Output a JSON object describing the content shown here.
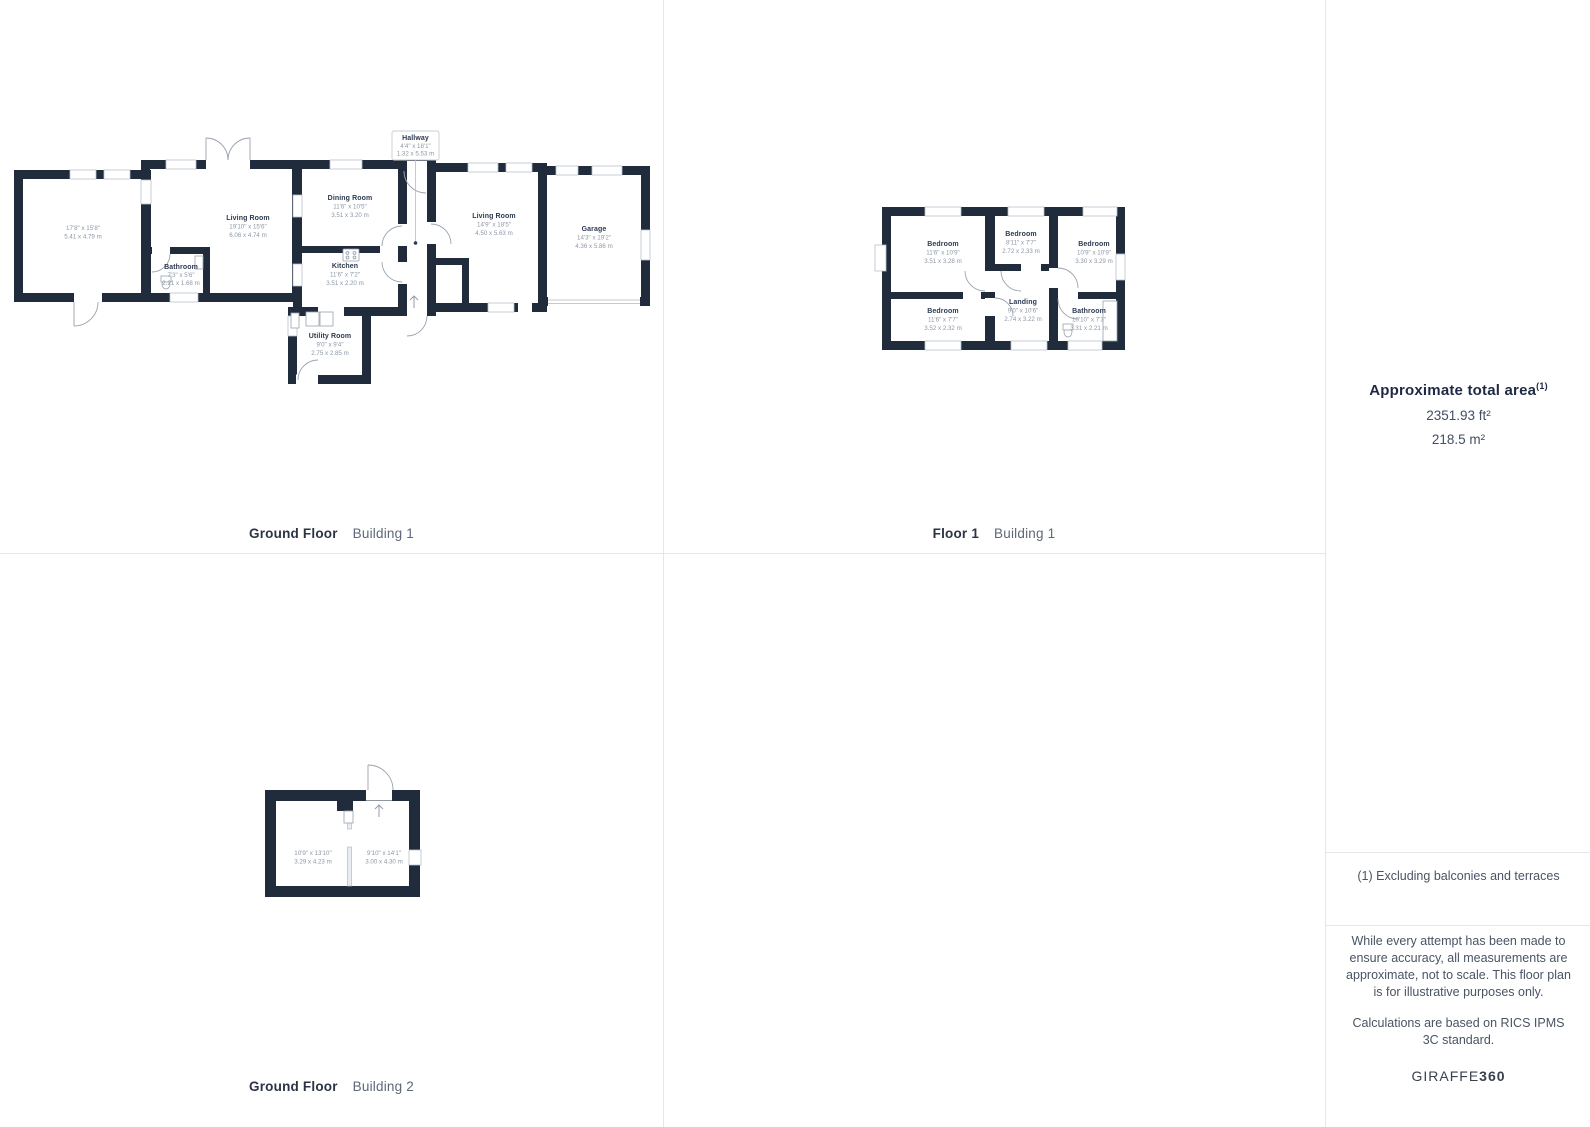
{
  "colors": {
    "wall": "#202c3c",
    "room_name": "#2c3a52",
    "room_dims": "#8e97a6",
    "divider": "#e4e6ea"
  },
  "plans": {
    "gf_b1": {
      "caption": {
        "floor": "Ground Floor",
        "building": "Building 1"
      },
      "rooms": [
        {
          "name": "",
          "imperial": "17'8\" x 15'8\"",
          "metric": "5.41 x 4.79 m"
        },
        {
          "name": "Living Room",
          "imperial": "19'10\" x 15'6\"",
          "metric": "6.06 x 4.74 m"
        },
        {
          "name": "Bathroom",
          "imperial": "7'3\" x 5'6\"",
          "metric": "2.21 x 1.68 m"
        },
        {
          "name": "Dining Room",
          "imperial": "11'6\" x 10'5\"",
          "metric": "3.51 x 3.20 m"
        },
        {
          "name": "Kitchen",
          "imperial": "11'6\" x 7'2\"",
          "metric": "3.51 x 2.20 m"
        },
        {
          "name": "Hallway",
          "imperial": "4'4\" x 18'1\"",
          "metric": "1.32 x 5.53 m"
        },
        {
          "name": "Living Room",
          "imperial": "14'9\" x 18'5\"",
          "metric": "4.50 x 5.63 m"
        },
        {
          "name": "Garage",
          "imperial": "14'3\" x 19'2\"",
          "metric": "4.36 x 5.86 m"
        },
        {
          "name": "Utility Room",
          "imperial": "9'0\" x 9'4\"",
          "metric": "2.75 x 2.85 m"
        }
      ]
    },
    "f1_b1": {
      "caption": {
        "floor": "Floor 1",
        "building": "Building 1"
      },
      "rooms": [
        {
          "name": "Bedroom",
          "imperial": "11'6\" x 10'9\"",
          "metric": "3.51 x 3.28 m"
        },
        {
          "name": "Bedroom",
          "imperial": "8'11\" x 7'7\"",
          "metric": "2.72 x 2.33 m"
        },
        {
          "name": "Bedroom",
          "imperial": "10'9\" x 10'9\"",
          "metric": "3.30 x 3.29 m"
        },
        {
          "name": "Bedroom",
          "imperial": "11'6\" x 7'7\"",
          "metric": "3.52 x 2.32 m"
        },
        {
          "name": "Landing",
          "imperial": "9'0\" x 10'6\"",
          "metric": "2.74 x 3.22 m"
        },
        {
          "name": "Bathroom",
          "imperial": "10'10\" x 7'3\"",
          "metric": "3.31 x 2.21 m"
        }
      ]
    },
    "gf_b2": {
      "caption": {
        "floor": "Ground Floor",
        "building": "Building 2"
      },
      "rooms": [
        {
          "name": "",
          "imperial": "10'9\" x 13'10\"",
          "metric": "3.29 x 4.23 m"
        },
        {
          "name": "",
          "imperial": "9'10\" x 14'1\"",
          "metric": "3.00 x 4.30 m"
        }
      ]
    }
  },
  "sidebar": {
    "area_title": "Approximate total area",
    "area_marker": "(1)",
    "area_ft": "2351.93 ft²",
    "area_m": "218.5 m²",
    "footnote": "(1) Excluding balconies and terraces",
    "disclaimer": "While every attempt has been made to ensure accuracy, all measurements are approximate, not to scale. This floor plan is for illustrative purposes only.",
    "standard": "Calculations are based on RICS IPMS 3C standard.",
    "brand": "GIRAFFE",
    "brand_suffix": "360"
  }
}
